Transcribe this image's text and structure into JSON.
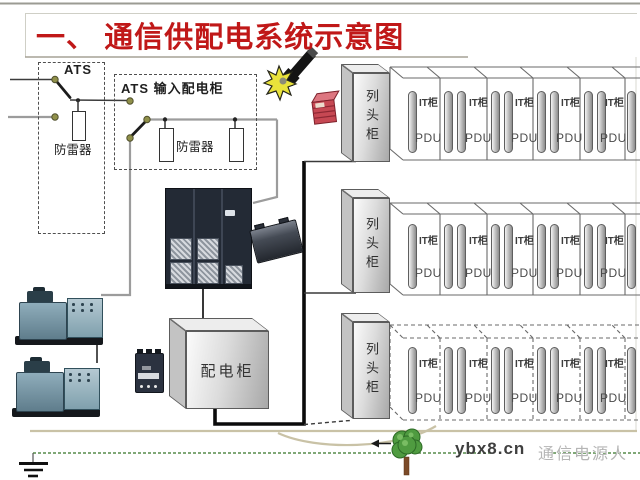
{
  "slide": {
    "title": "一、 通信供配电系统示意图",
    "footer": {
      "site": "ybx8.cn",
      "brand": "通信电源人"
    }
  },
  "circuit": {
    "ats_box_label": "ATS",
    "input_cabinet_label": "ATS 输入配电柜",
    "surge_arrester_label_ats": "防雷器",
    "surge_arrester_label_input": "防雷器",
    "distribution_cabinet_label": "配电柜"
  },
  "racks": {
    "row_head_cabinet_label": "列头柜",
    "it_cabinet_label": "IT柜",
    "pdu_label": "PDU",
    "row_count": 3,
    "it_cabinets_per_row": 5
  },
  "colors": {
    "title_red": "#c01818",
    "footer_tan": "#c9c2a6",
    "footer_green": "#6f9c64"
  }
}
